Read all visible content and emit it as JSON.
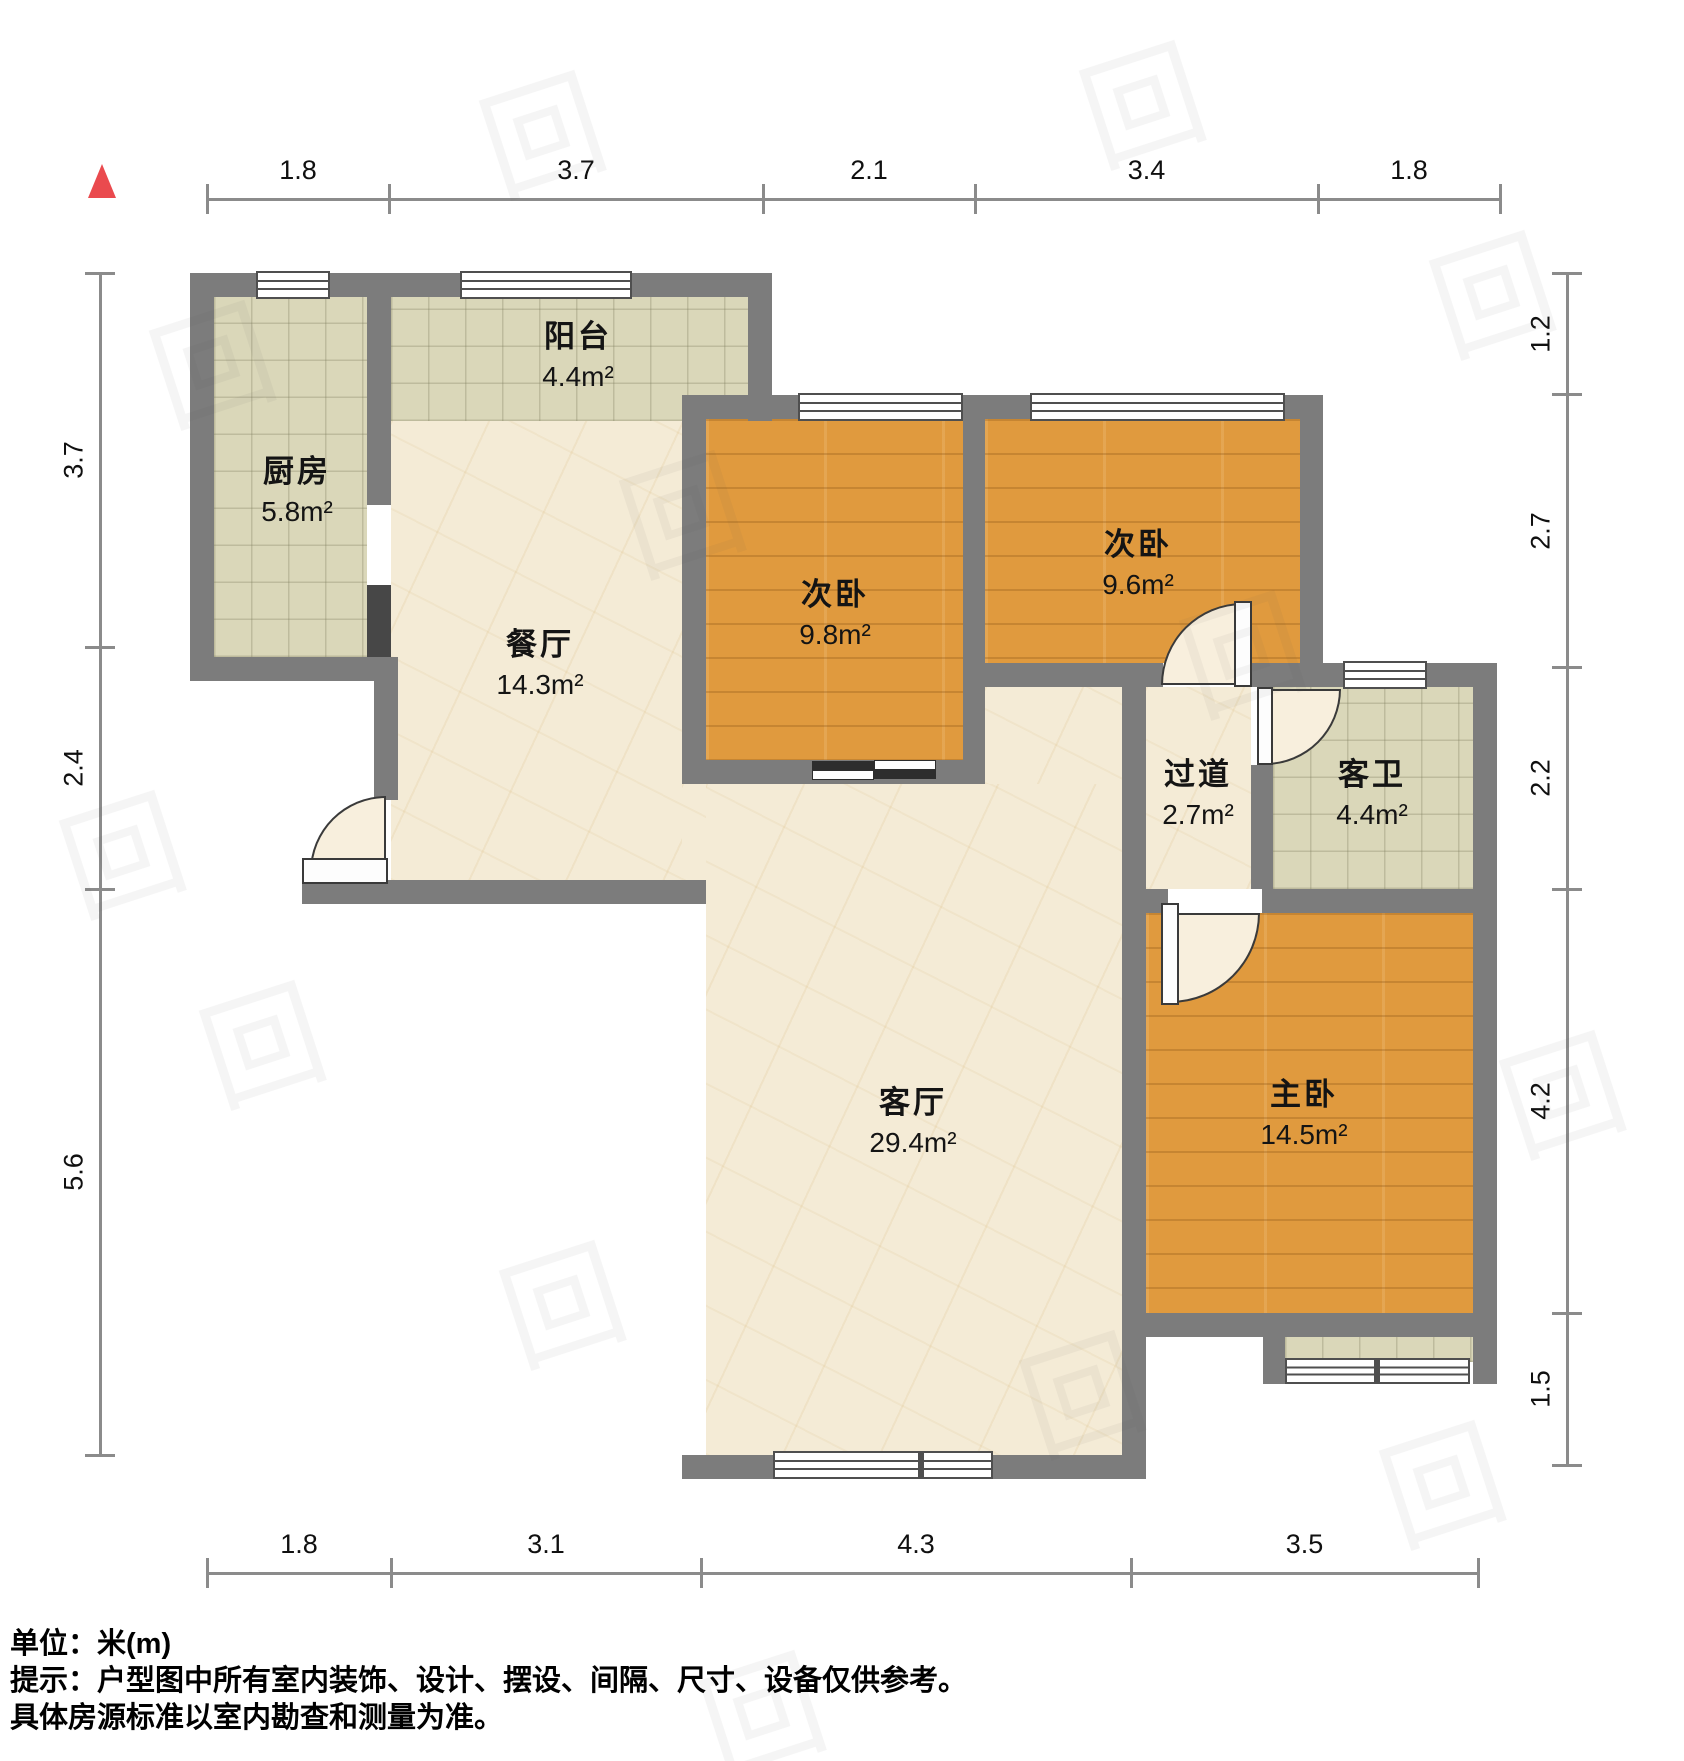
{
  "page": {
    "background": "#ffffff"
  },
  "colors": {
    "wall": "#7c7c7c",
    "wood_floor": "#e09a3e",
    "tile_floor": "#dad7b9",
    "marble_floor": "#f4ebd6",
    "north_marker": "#ea4a4e",
    "ruler": "#8b8b8b"
  },
  "rooms": [
    {
      "key": "balcony",
      "name": "阳台",
      "area": "4.4m²",
      "cx": 578,
      "cy": 352
    },
    {
      "key": "kitchen",
      "name": "厨房",
      "area": "5.8m²",
      "cx": 297,
      "cy": 487
    },
    {
      "key": "dining",
      "name": "餐厅",
      "area": "14.3m²",
      "cx": 540,
      "cy": 660
    },
    {
      "key": "bedroom-a",
      "name": "次卧",
      "area": "9.8m²",
      "cx": 835,
      "cy": 610
    },
    {
      "key": "bedroom-b",
      "name": "次卧",
      "area": "9.6m²",
      "cx": 1138,
      "cy": 560
    },
    {
      "key": "hallway",
      "name": "过道",
      "area": "2.7m²",
      "cx": 1198,
      "cy": 790
    },
    {
      "key": "guest-bath",
      "name": "客卫",
      "area": "4.4m²",
      "cx": 1372,
      "cy": 790
    },
    {
      "key": "living",
      "name": "客厅",
      "area": "29.4m²",
      "cx": 913,
      "cy": 1118
    },
    {
      "key": "master",
      "name": "主卧",
      "area": "14.5m²",
      "cx": 1304,
      "cy": 1110
    }
  ],
  "rulers": {
    "top": {
      "orientation": "h",
      "line": 199,
      "label_line": 186,
      "ticks": [
        207,
        389,
        763,
        975,
        1318,
        1500
      ],
      "labels": [
        "1.8",
        "3.7",
        "2.1",
        "3.4",
        "1.8"
      ]
    },
    "bottom": {
      "orientation": "h",
      "line": 1573,
      "label_line": 1560,
      "ticks": [
        207,
        391,
        701,
        1131,
        1478
      ],
      "labels": [
        "1.8",
        "3.1",
        "4.3",
        "3.5"
      ]
    },
    "left": {
      "orientation": "v",
      "line": 100,
      "label_line": 74,
      "ticks": [
        273,
        647,
        889,
        1455
      ],
      "labels": [
        "3.7",
        "2.4",
        "5.6"
      ]
    },
    "right": {
      "orientation": "v",
      "line": 1567,
      "label_line": 1541,
      "ticks": [
        273,
        394,
        667,
        889,
        1313,
        1465
      ],
      "labels": [
        "1.2",
        "2.7",
        "2.2",
        "4.2",
        "1.5"
      ]
    }
  },
  "footer": {
    "line1": "单位：米(m)",
    "line2": "提示：户型图中所有室内装饰、设计、摆设、间隔、尺寸、设备仅供参考。",
    "line3": "具体房源标准以室内勘查和测量为准。"
  },
  "watermark_glyph": "回"
}
